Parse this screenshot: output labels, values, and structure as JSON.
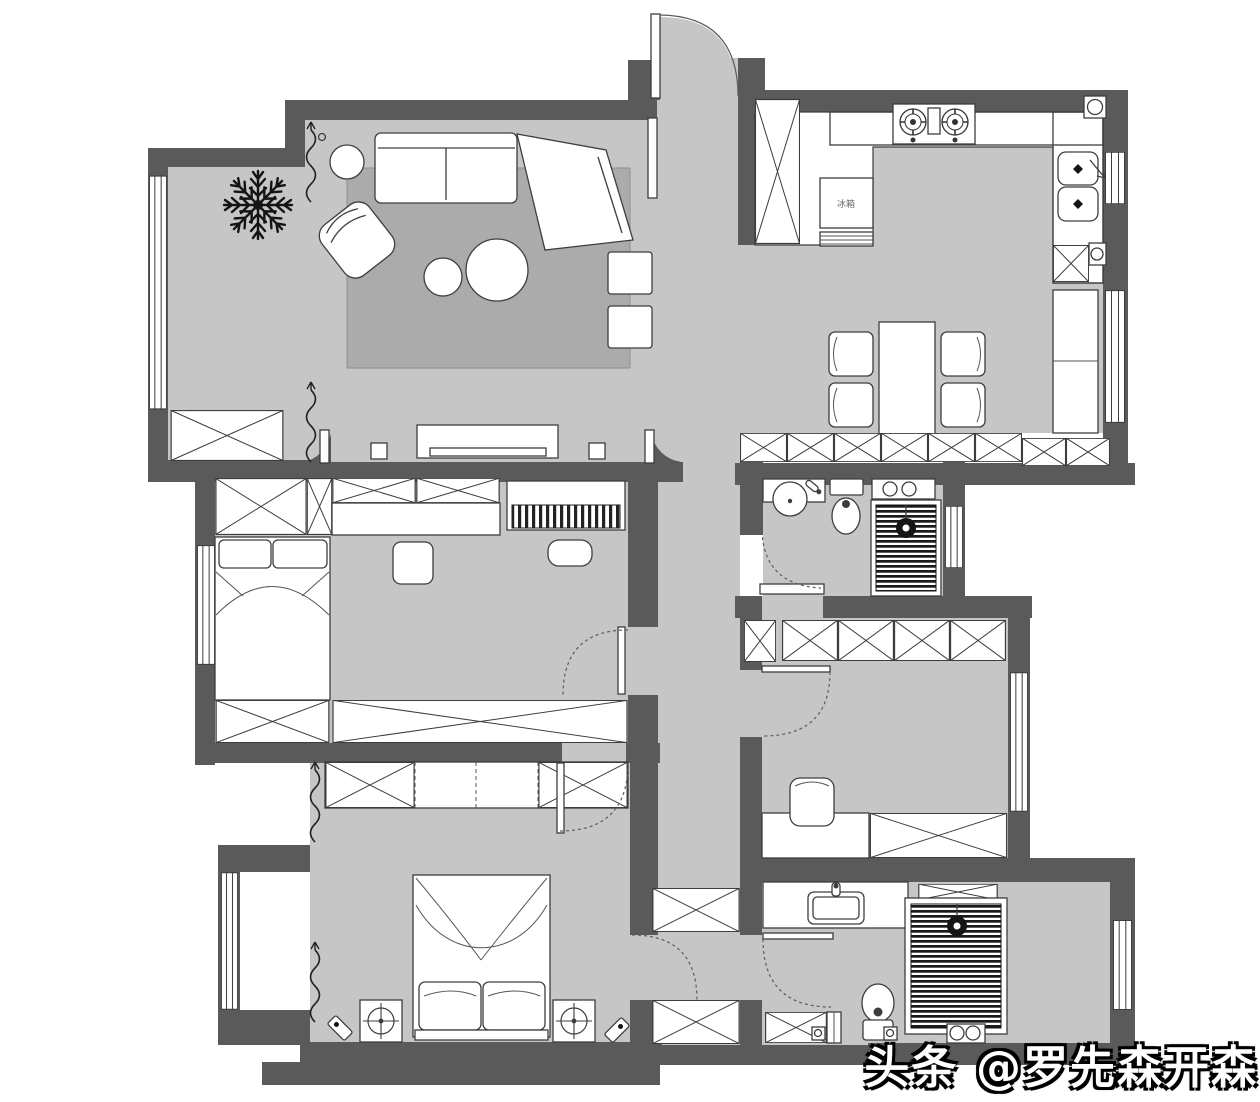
{
  "watermark": {
    "text": "头条 @罗先森开森"
  },
  "labels": {
    "fridge": "冰箱"
  },
  "palette": {
    "wall": "#5a5a5a",
    "floor": "#c6c6c6",
    "rug": "#ababab",
    "line": "#3d3d3d",
    "shower_hatch": "#1a1a1a",
    "furniture": "#ffffff",
    "plant": "#141414",
    "watermark_fill": "#ffffff",
    "watermark_outline": "#000000"
  },
  "legend": {
    "balcony": [
      "plant-icon",
      "curtain-icon",
      "storage-cabinet-x-icon",
      "window-icon"
    ],
    "living_room": [
      "sectional-sofa-icon",
      "armchair-icon",
      "round-side-table-icon",
      "coffee-table-icon",
      "stool-icon",
      "rug",
      "tv-console-icon",
      "tv-icon",
      "speaker-icon"
    ],
    "entry": [
      "entry-door-arc-icon",
      "tall-cabinet-x-icon"
    ],
    "kitchen": [
      "gas-stove-icon",
      "double-sink-icon",
      "fridge-icon",
      "counter",
      "corner-basin-icon"
    ],
    "dining_room": [
      "dining-table-icon",
      "dining-chair-icon",
      "sideboard-cabinet-x-icon",
      "window-icon"
    ],
    "bathroom_mid": [
      "round-basin-icon",
      "toilet-icon",
      "washer-counter-icon",
      "shower-hatch-icon",
      "shower-head-icon",
      "door-arc-icon"
    ],
    "study": [
      "wardrobe-x-icon",
      "desk",
      "chair-icon",
      "window-icon",
      "door-arc-icon"
    ],
    "bedroom_second": [
      "double-bed-icon",
      "pillow-icon",
      "wardrobe-x-icon",
      "piano-icon",
      "piano-stool-icon",
      "nightstand-icon",
      "window-icon",
      "door-arc-icon"
    ],
    "master_bedroom": [
      "double-bed-icon",
      "pillow-icon",
      "nightstand-lamp-icon",
      "wall-sconce-icon",
      "wardrobe-x-icon",
      "curtain-icon",
      "bay-window-icon",
      "door-arc-icon"
    ],
    "master_bathroom": [
      "vanity-sink-icon",
      "toilet-icon",
      "shower-hatch-icon",
      "shower-head-icon",
      "floor-drain-icon",
      "shoe-cabinet-x-icon",
      "meter-icon",
      "window-icon",
      "door-arc-icon"
    ],
    "corridor": [
      "storage-cabinet-x-icon",
      "door-arc-icon"
    ]
  }
}
